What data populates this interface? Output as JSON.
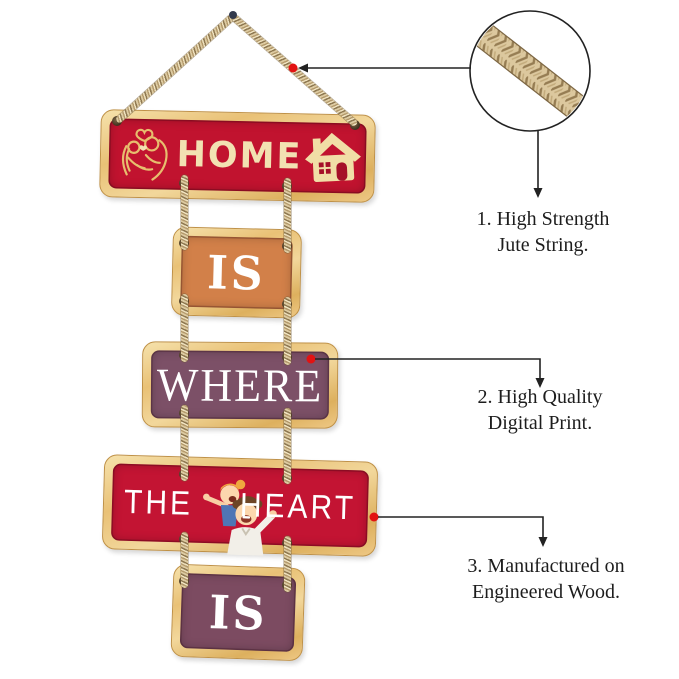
{
  "planks": [
    {
      "name": "home",
      "label": "HOME",
      "bg": "#C1132F",
      "fg": "#F2E1B2"
    },
    {
      "name": "is-top",
      "label": "IS",
      "bg": "#D28049",
      "fg": "#FFFFFF"
    },
    {
      "name": "where",
      "label": "WHERE",
      "bg": "#7C5067",
      "fg": "#FFFFFF"
    },
    {
      "name": "the-heart",
      "label_left": "THE",
      "label_right": "HEART",
      "bg": "#C31433",
      "fg": "#FFFFFF"
    },
    {
      "name": "is-bottom",
      "label": "IS",
      "bg": "#7C4B61",
      "fg": "#FFFFFF"
    }
  ],
  "annotations": [
    {
      "line1": "1. High Strength",
      "line2": "Jute String."
    },
    {
      "line1": "2. High Quality",
      "line2": "Digital Print."
    },
    {
      "line1": "3. Manufactured on",
      "line2": "Engineered Wood."
    }
  ],
  "colors": {
    "frame_gold": "#EAC37A",
    "rope": "#CBB48C",
    "callout_line": "#222222",
    "callout_dot": "#E21212",
    "annotation_text": "#1D1D1D",
    "pin": "#333A4D"
  },
  "icons": {
    "couple_line_art": "embracing couple line art",
    "house": "house with chimney",
    "cartoon_couple": "cartoon couple piggyback",
    "magnifier": "jute rope close-up circle",
    "push_pin": "hanging pin"
  }
}
